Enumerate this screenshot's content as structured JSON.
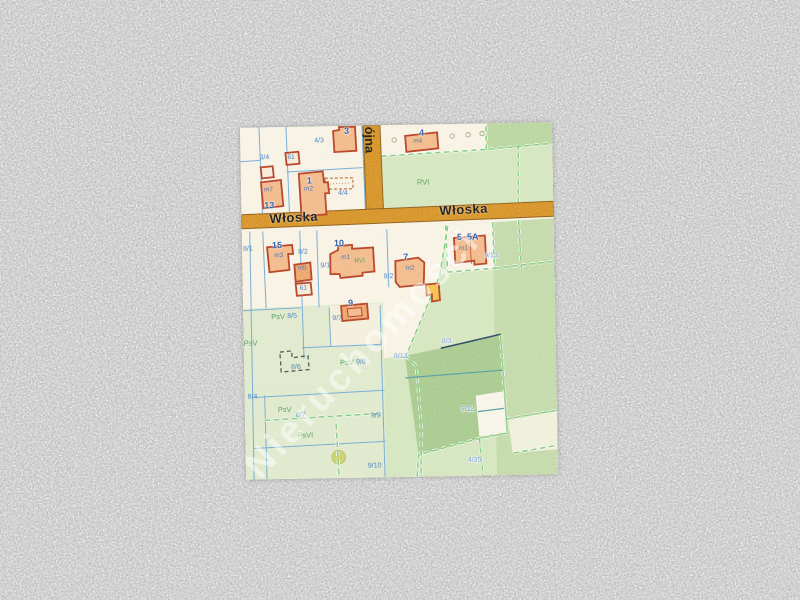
{
  "map": {
    "streets": {
      "wloska_a": "Włoska",
      "wloska_b": "Włoska",
      "vertical": "ójna"
    },
    "watermark": "Nieruchomości",
    "class_labels": [
      "RVI",
      "RVI",
      "PsV",
      "PsV",
      "PsV",
      "PsV",
      "PsVI"
    ],
    "parcel_labels": [
      "3/4",
      "4/3",
      "4/4",
      "8/1",
      "8/2",
      "9/1",
      "9/2",
      "9/13",
      "8/5",
      "9/7",
      "9/8",
      "8/6",
      "8/12",
      "8/4",
      "8/7",
      "9/9",
      "9/10",
      "8/3",
      "9/12",
      "4/35"
    ],
    "address_labels": [
      "3",
      "4",
      "1",
      "13",
      "15",
      "10",
      "7",
      "9",
      "5",
      "5A"
    ],
    "building_labels": [
      "m2",
      "m4",
      "m7",
      "m3",
      "m5",
      "m1",
      "m2",
      "m1",
      "61",
      "61"
    ],
    "colors": {
      "background_noise": "#c6c6c6",
      "map_base": "#f7f2e3",
      "road": "#d6901f",
      "building_outline": "#b33a1e",
      "building_fill": "#f2b887",
      "parcel_line": "#6fa8d6",
      "class_boundary_dash": "#7cc97c",
      "parcel_text": "#3f7ec0",
      "class_text": "#4f9d55",
      "address_text": "#2456a8",
      "green_light": "#d4e5bd",
      "green_medium": "#a6c98b"
    }
  }
}
